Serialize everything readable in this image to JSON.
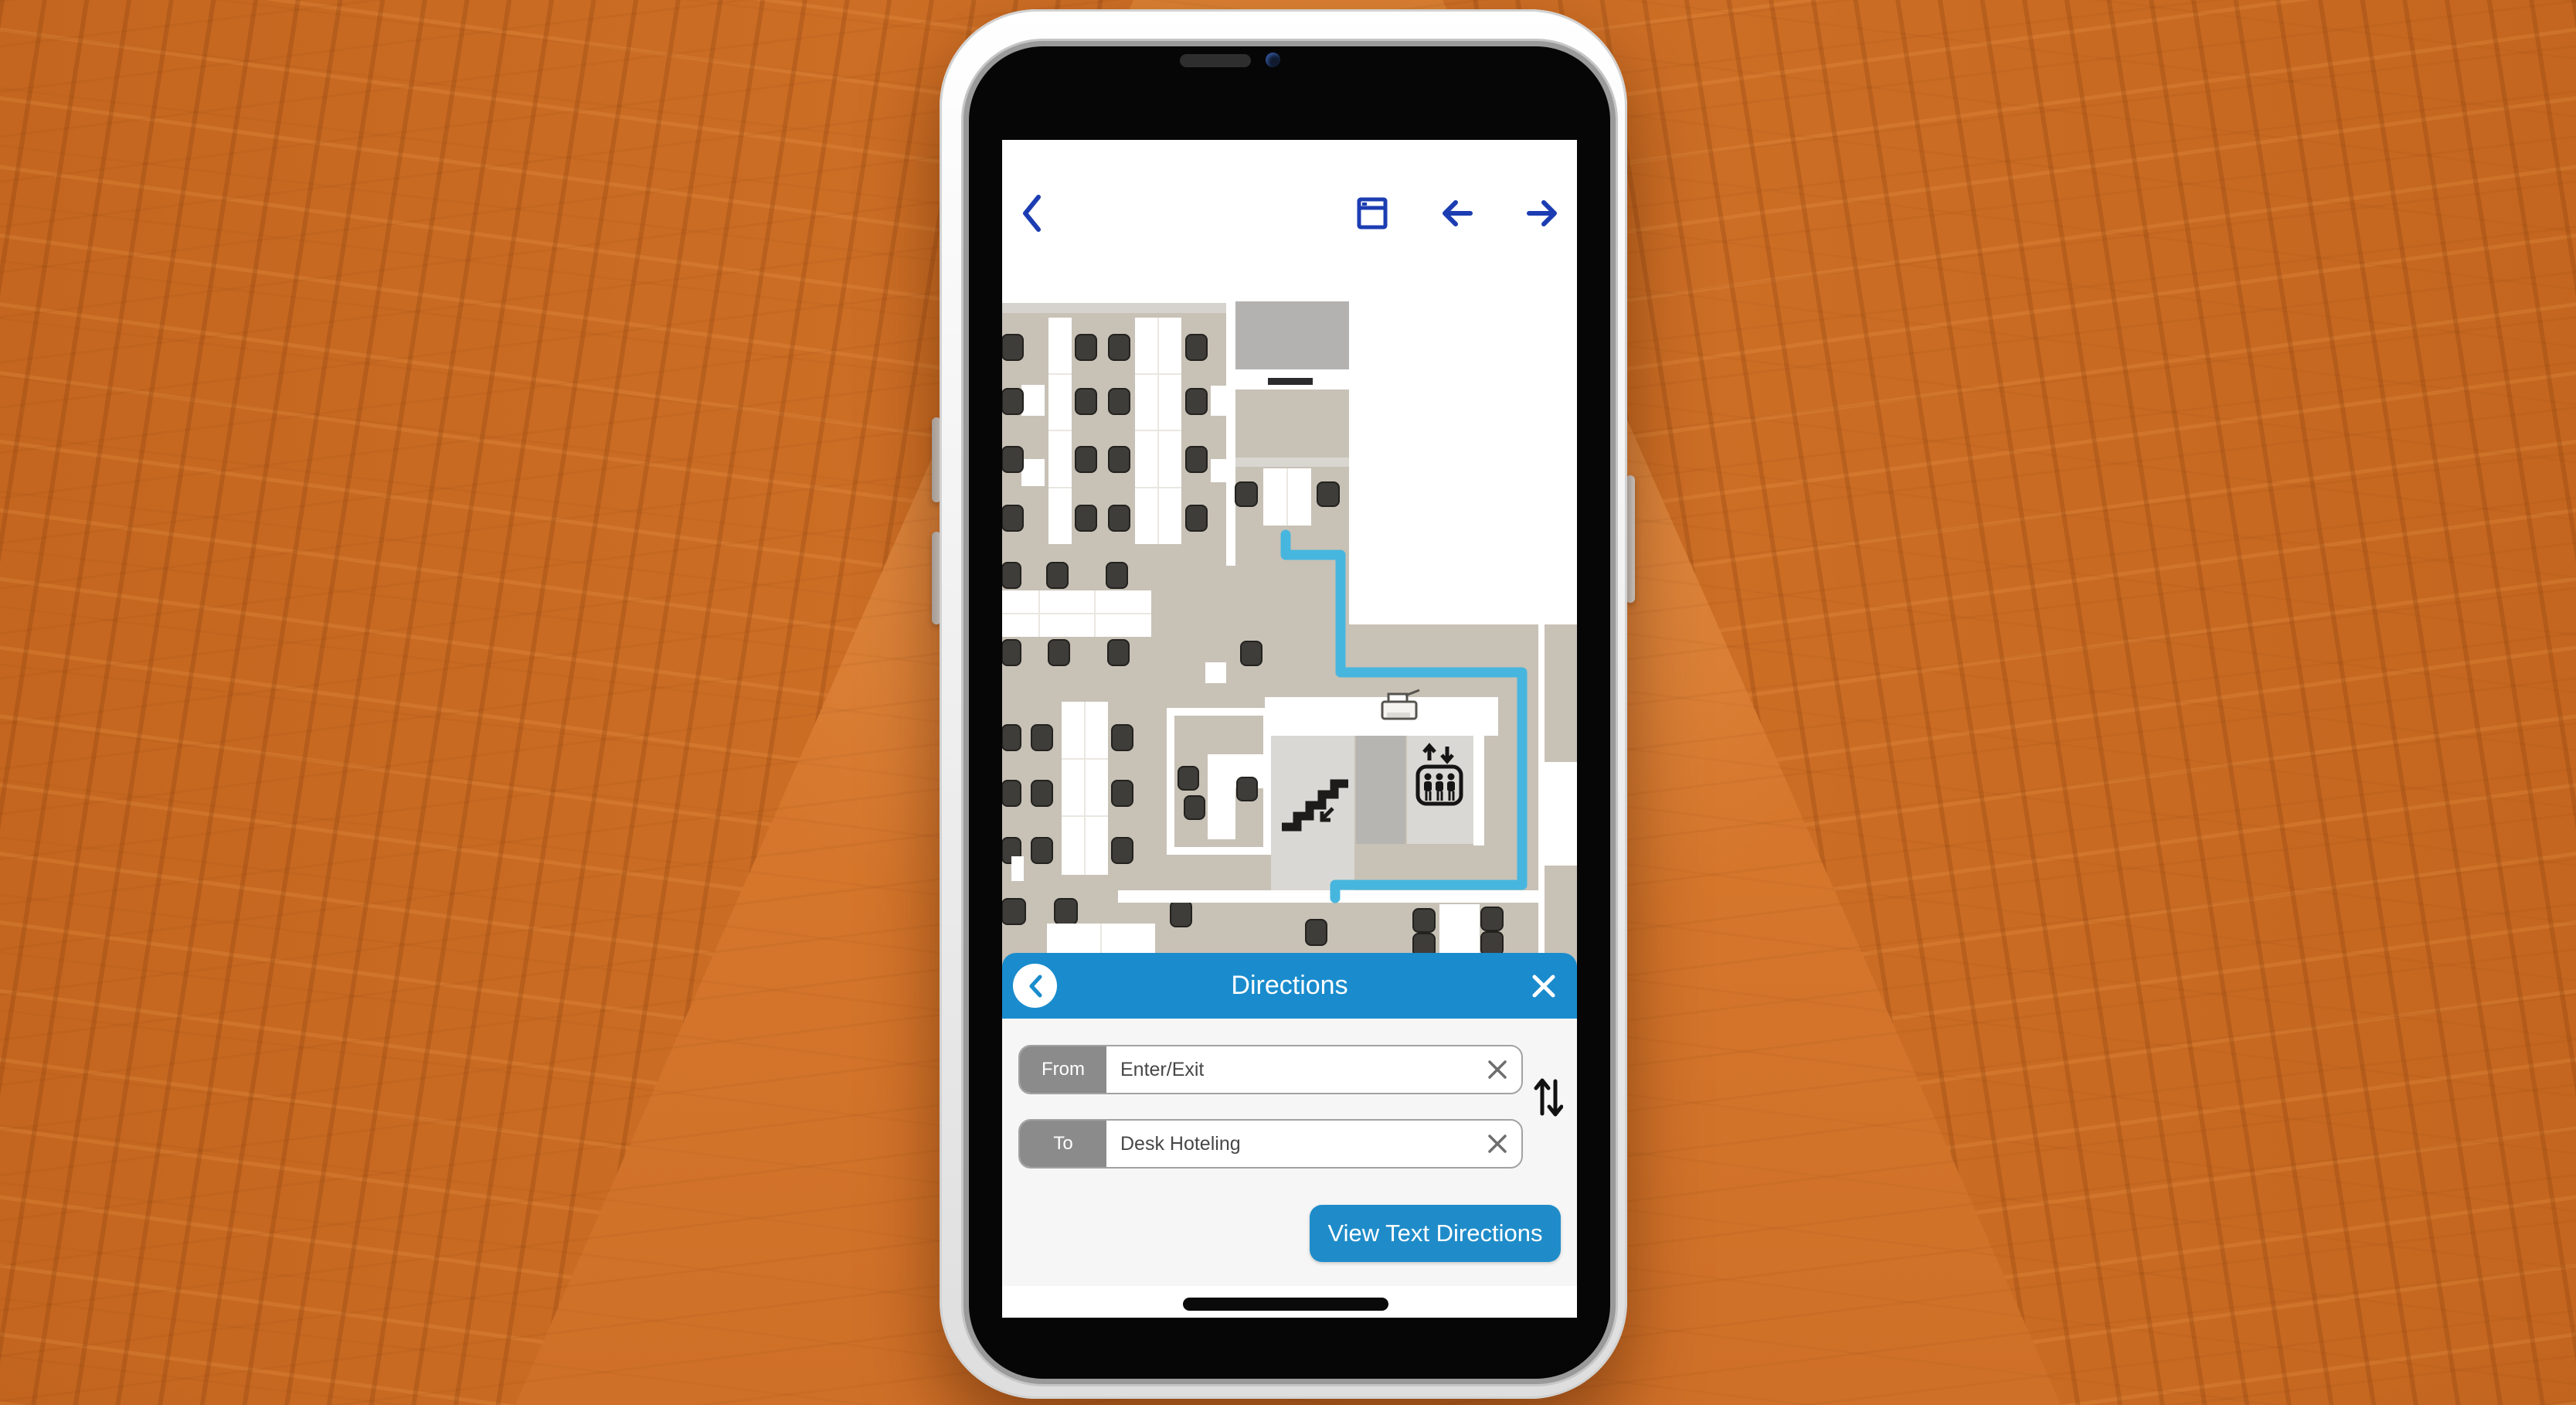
{
  "device": {
    "type": "smartphone-mockup",
    "background": "orange tinted skyscrapers viewed from below"
  },
  "nav": {
    "back_icon": "chevron-left",
    "window_icon": "window",
    "prev_icon": "arrow-left",
    "next_icon": "arrow-right",
    "icon_color": "#1c3db2"
  },
  "map": {
    "description": "indoor office floor plan",
    "floor_color": "#c8c1b6",
    "route_color": "#47b6de",
    "route_points": "367,392 367,418 438,418 438,570 673,570 673,845 431,845 431,862",
    "poi_icons": [
      "stairs-icon",
      "elevator-icon",
      "printer-icon"
    ]
  },
  "directions_panel": {
    "title": "Directions",
    "header_color": "#1a8ccd",
    "back_icon": "chevron-left-circle",
    "close_icon": "x",
    "from": {
      "label": "From",
      "value": "Enter/Exit",
      "clear_icon": "x"
    },
    "to": {
      "label": "To",
      "value": "Desk Hoteling",
      "clear_icon": "x"
    },
    "swap_icon": "swap-vertical",
    "button_label": "View Text Directions",
    "button_color": "#1f8cc9"
  }
}
